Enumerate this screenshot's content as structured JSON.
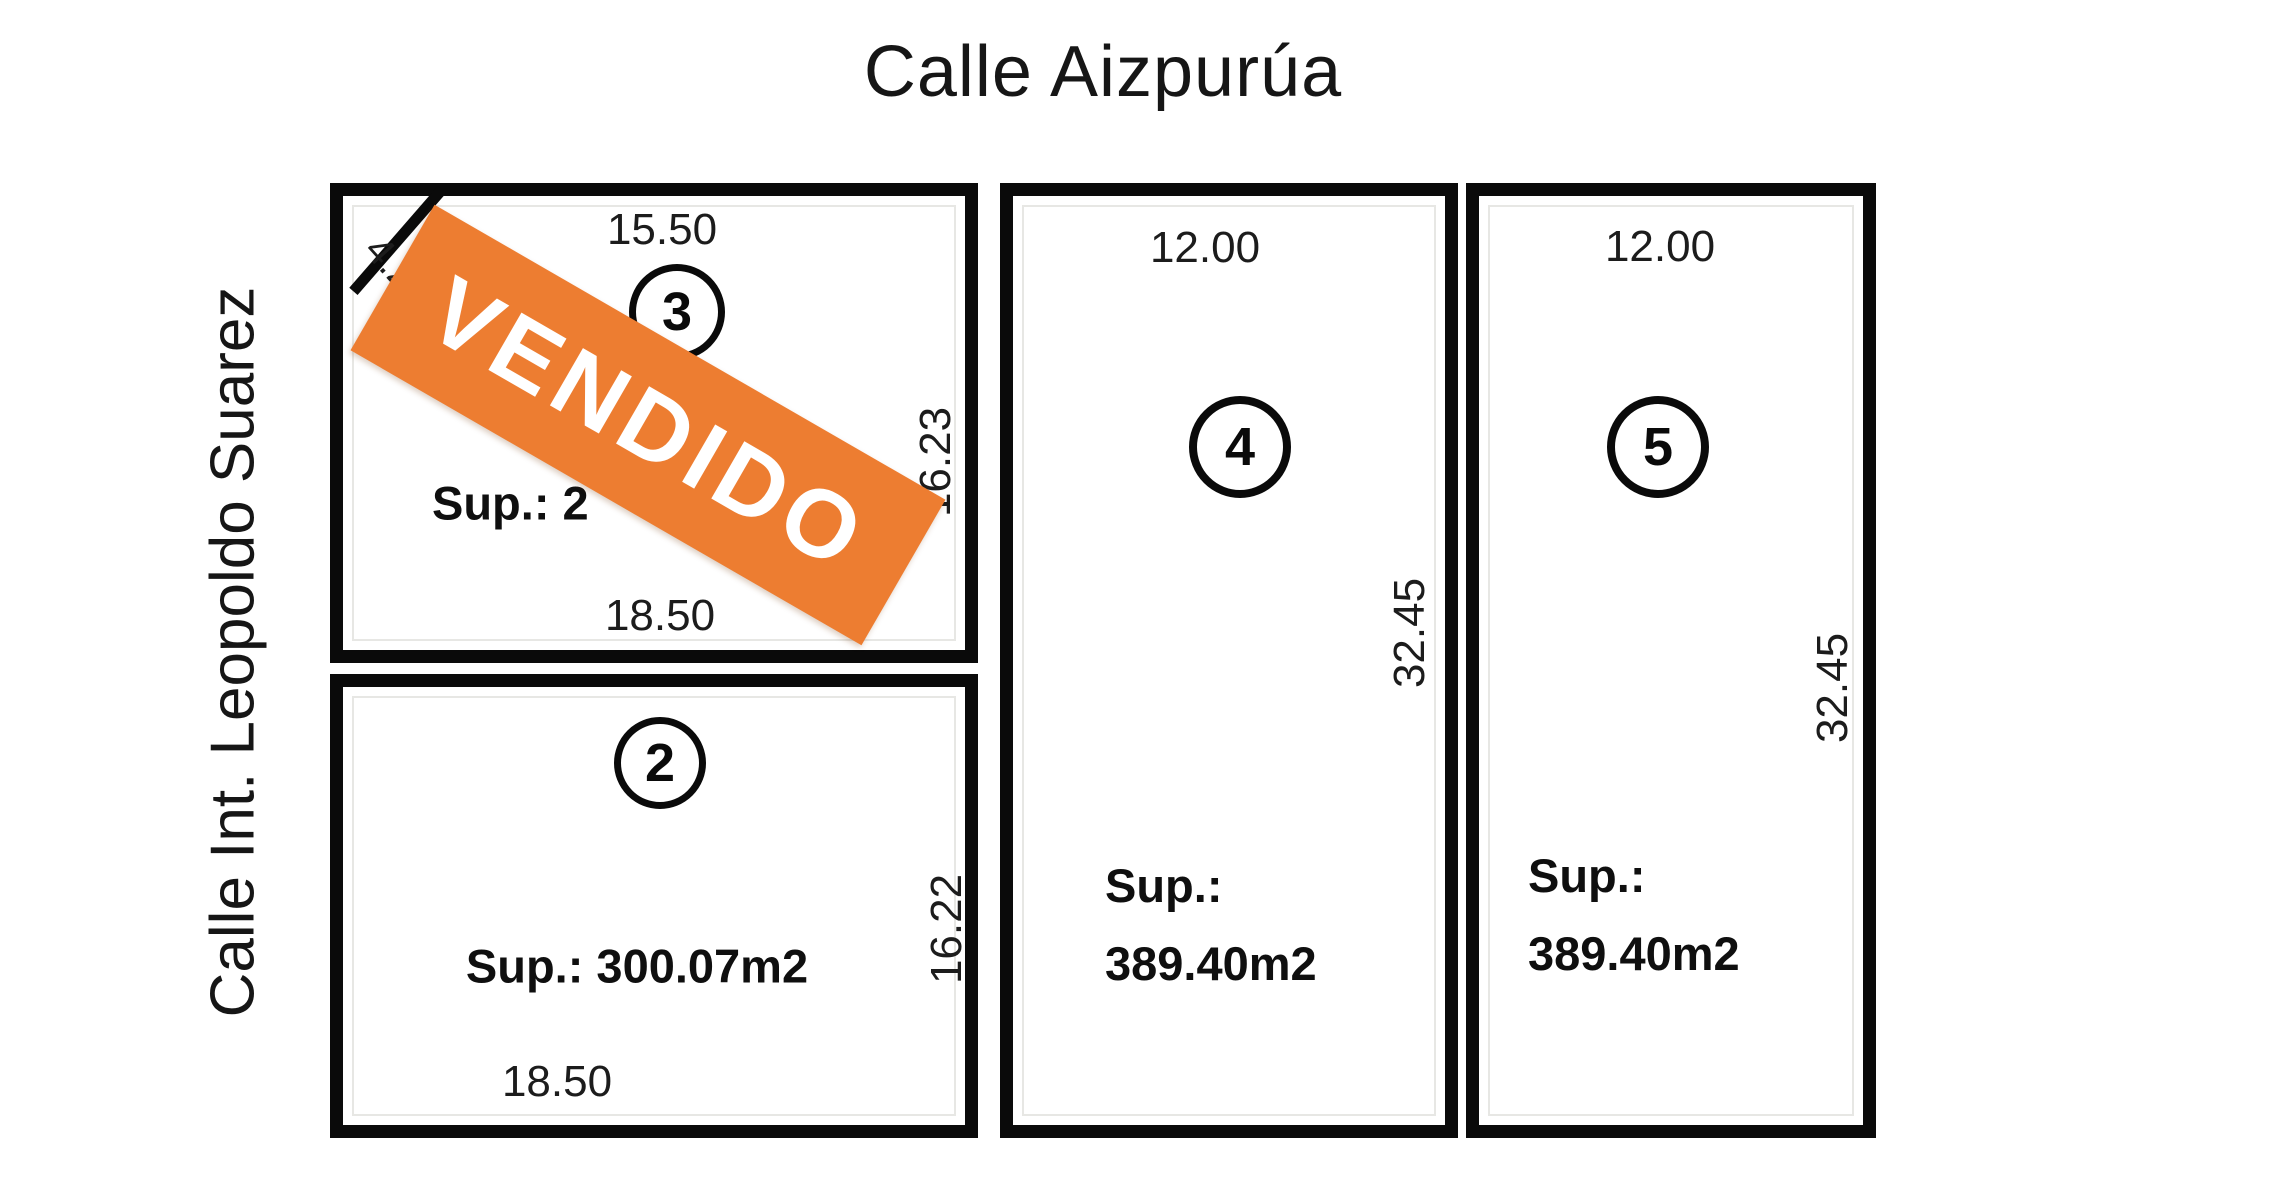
{
  "streets": {
    "top": "Calle Aizpurúa",
    "left": "Calle Int. Leopoldo Suarez"
  },
  "banner": {
    "text": "VENDIDO",
    "color": "#ED7D31",
    "text_color": "#FFFFFF",
    "rotation_deg": 30
  },
  "line_color": "#0a0a0a",
  "lots": {
    "lot3": {
      "number": "3",
      "dim_top": "15.50",
      "dim_right": "16.23",
      "dim_bottom": "18.50",
      "dim_corner": "4.24",
      "sup_visible": "Sup.: 2",
      "status": "sold"
    },
    "lot2": {
      "number": "2",
      "dim_right": "16.22",
      "dim_bottom": "18.50",
      "sup": "Sup.: 300.07m2"
    },
    "lot4": {
      "number": "4",
      "dim_top": "12.00",
      "dim_side": "32.45",
      "sup_line1": "Sup.:",
      "sup_line2": "389.40m2"
    },
    "lot5": {
      "number": "5",
      "dim_top": "12.00",
      "dim_side": "32.45",
      "sup_line1": "Sup.:",
      "sup_line2": "389.40m2"
    }
  }
}
